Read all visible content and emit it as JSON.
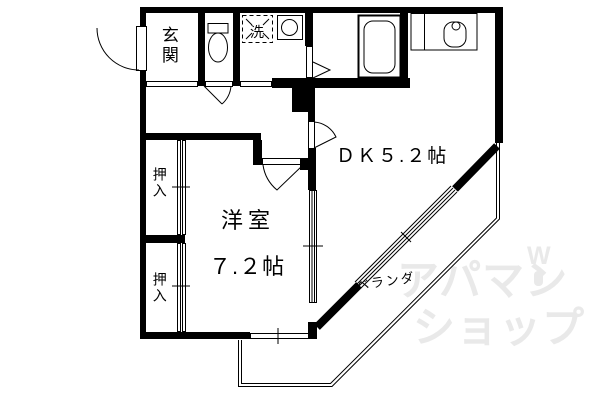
{
  "colors": {
    "line": "#000000",
    "background": "#ffffff",
    "watermark": "#e9e9e9"
  },
  "floorplan": {
    "labels": {
      "genkan": "玄関",
      "laundry": "洗",
      "dk": "ＤＫ５.２帖",
      "room": "洋室",
      "room_size": "７.２帖",
      "closet_upper": "押入",
      "closet_lower": "押入",
      "veranda": "ベランダ"
    },
    "icons": {
      "entrance_door": "door-swing-arc",
      "toilet": "toilet-tank-and-bowl",
      "washing_machine": "washing-machine-pan",
      "washbasin": "washbasin-circle",
      "bathtub": "bathtub",
      "kitchen_sink": "kitchen-counter-sink",
      "windows": "double-line-window",
      "veranda_edge": "balcony-outline"
    },
    "watermark": {
      "line1": "アパマン",
      "line2": "ショップ",
      "mark": "W"
    }
  }
}
